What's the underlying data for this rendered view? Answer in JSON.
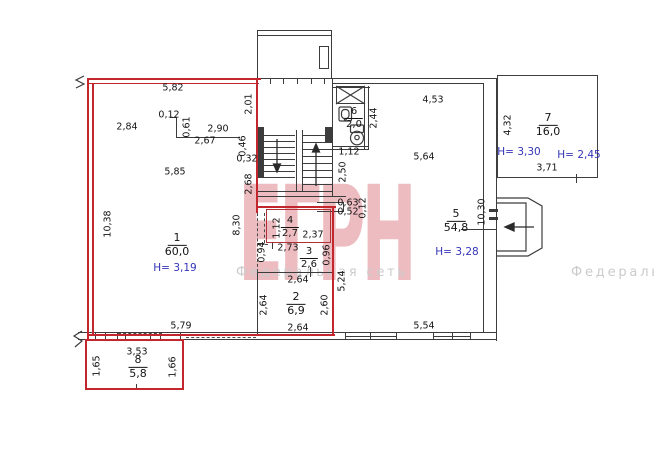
{
  "watermark": {
    "brand": "ЕГРН",
    "network": "Федеральная сеть",
    "brand_color": "#cd4650",
    "network_color": "#cbcbcb"
  },
  "colors": {
    "boundary_red": "#c1272d",
    "wall_black": "#3c3c3c",
    "height_blue": "#3434b8"
  },
  "plan": {
    "rooms": [
      {
        "number": "1",
        "area": "60,0",
        "x": 177,
        "y": 245,
        "small": false
      },
      {
        "number": "2",
        "area": "6,9",
        "x": 296,
        "y": 304,
        "small": false
      },
      {
        "number": "3",
        "area": "2,6",
        "x": 309,
        "y": 258,
        "small": true
      },
      {
        "number": "4",
        "area": "2,7",
        "x": 290,
        "y": 227,
        "small": true
      },
      {
        "number": "5",
        "area": "54,8",
        "x": 456,
        "y": 221,
        "small": false
      },
      {
        "number": "6",
        "area": "2,0",
        "x": 354,
        "y": 118,
        "small": true
      },
      {
        "number": "7",
        "area": "16,0",
        "x": 548,
        "y": 125,
        "small": false
      },
      {
        "number": "8",
        "area": "5,8",
        "x": 138,
        "y": 367,
        "small": false
      }
    ],
    "heights": [
      {
        "text": "H= 3,19",
        "x": 175,
        "y": 268
      },
      {
        "text": "H= 3,28",
        "x": 457,
        "y": 252
      },
      {
        "text": "H= 3,30",
        "x": 519,
        "y": 152
      },
      {
        "text": "H= 2,45",
        "x": 579,
        "y": 155
      }
    ],
    "dimensions": [
      {
        "text": "5,82",
        "x": 173,
        "y": 88
      },
      {
        "text": "2,84",
        "x": 127,
        "y": 127
      },
      {
        "text": "0,12",
        "x": 169,
        "y": 115
      },
      {
        "text": "0,61",
        "x": 187,
        "y": 127,
        "r": 1
      },
      {
        "text": "2,90",
        "x": 218,
        "y": 129
      },
      {
        "text": "2,67",
        "x": 205,
        "y": 141
      },
      {
        "text": "0,46",
        "x": 243,
        "y": 146,
        "r": 1
      },
      {
        "text": "0,32",
        "x": 247,
        "y": 159
      },
      {
        "text": "2,01",
        "x": 249,
        "y": 104,
        "r": 1
      },
      {
        "text": "5,85",
        "x": 175,
        "y": 172
      },
      {
        "text": "2,68",
        "x": 249,
        "y": 184,
        "r": 1
      },
      {
        "text": "10,38",
        "x": 108,
        "y": 224,
        "r": 1
      },
      {
        "text": "8,30",
        "x": 237,
        "y": 225,
        "r": 1
      },
      {
        "text": "5,79",
        "x": 181,
        "y": 326
      },
      {
        "text": "3,53",
        "x": 137,
        "y": 352
      },
      {
        "text": "1,65",
        "x": 97,
        "y": 366,
        "r": 1
      },
      {
        "text": "1,66",
        "x": 173,
        "y": 367,
        "r": 1
      },
      {
        "text": "2,44",
        "x": 374,
        "y": 118,
        "r": 1
      },
      {
        "text": "1,12",
        "x": 349,
        "y": 152
      },
      {
        "text": "2,50",
        "x": 343,
        "y": 172,
        "r": 1
      },
      {
        "text": "4,53",
        "x": 433,
        "y": 100
      },
      {
        "text": "5,64",
        "x": 424,
        "y": 157
      },
      {
        "text": "5,54",
        "x": 424,
        "y": 326
      },
      {
        "text": "10,30",
        "x": 482,
        "y": 212,
        "r": 1
      },
      {
        "text": "0,63",
        "x": 348,
        "y": 203
      },
      {
        "text": "0,52",
        "x": 348,
        "y": 212
      },
      {
        "text": "0,12",
        "x": 363,
        "y": 208,
        "r": 1
      },
      {
        "text": "5,24",
        "x": 342,
        "y": 281,
        "r": 1
      },
      {
        "text": "1,12",
        "x": 277,
        "y": 228,
        "r": 1
      },
      {
        "text": "2,37",
        "x": 313,
        "y": 235
      },
      {
        "text": "2,73",
        "x": 288,
        "y": 248
      },
      {
        "text": "0,94",
        "x": 262,
        "y": 252,
        "r": 1
      },
      {
        "text": "0,96",
        "x": 327,
        "y": 255,
        "r": 1
      },
      {
        "text": "2,64",
        "x": 298,
        "y": 280
      },
      {
        "text": "2,64",
        "x": 264,
        "y": 305,
        "r": 1
      },
      {
        "text": "2,60",
        "x": 325,
        "y": 305,
        "r": 1
      },
      {
        "text": "2,64",
        "x": 298,
        "y": 328
      },
      {
        "text": "4,32",
        "x": 508,
        "y": 125,
        "r": 1
      },
      {
        "text": "3,71",
        "x": 547,
        "y": 168
      }
    ]
  }
}
